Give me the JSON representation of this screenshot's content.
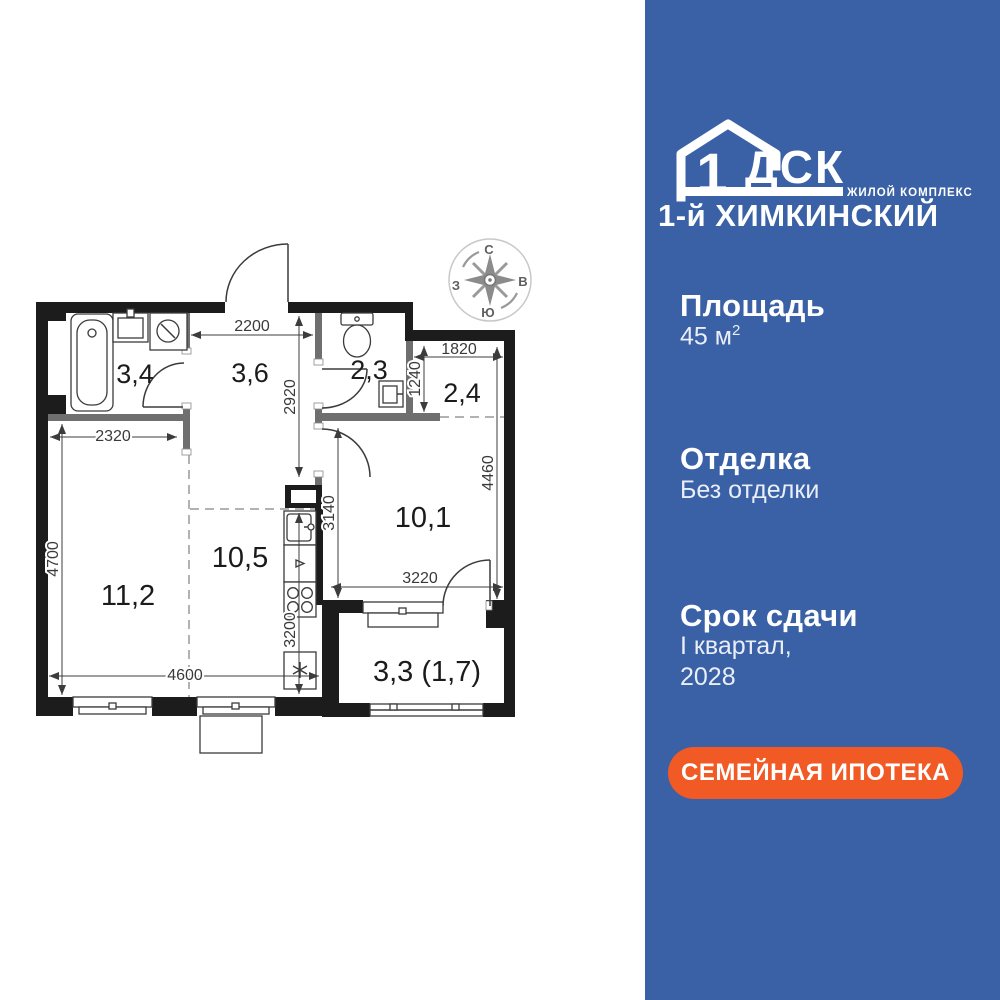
{
  "floorplan": {
    "room_labels": {
      "bathroom": "3,4",
      "hallway": "3,6",
      "toilet": "2,3",
      "wardrobe": "2,4",
      "bedroom": "10,1",
      "kitchen": "10,5",
      "living": "11,2",
      "balcony": "3,3 (1,7)"
    },
    "dimensions": {
      "hall_width": "2200",
      "hall_depth": "2920",
      "bath_width": "2320",
      "wardrobe_width": "1820",
      "wardrobe_depth": "1240",
      "bedroom_depth": "4460",
      "bedroom_inner_depth": "3140",
      "bedroom_width": "3220",
      "living_depth": "4700",
      "bottom_width": "4600",
      "kitchen_depth": "3200"
    },
    "compass": {
      "north": "С",
      "east": "В",
      "west": "З",
      "south": "Ю"
    }
  },
  "sidebar": {
    "background": "#3a61a6",
    "logo": {
      "number": "1",
      "letters": "ДСК",
      "tagline": "ЖИЛОЙ КОМПЛЕКС",
      "complex": "1-й ХИМКИНСКИЙ"
    },
    "sections": [
      {
        "title": "Площадь",
        "value": "45 м",
        "sup": "2"
      },
      {
        "title": "Отделка",
        "value": "Без отделки"
      },
      {
        "title": "Срок сдачи",
        "value": "I квартал,",
        "value2": "2028"
      }
    ],
    "cta": {
      "label": "СЕМЕЙНАЯ ИПОТЕКА",
      "color": "#f15a24"
    }
  }
}
